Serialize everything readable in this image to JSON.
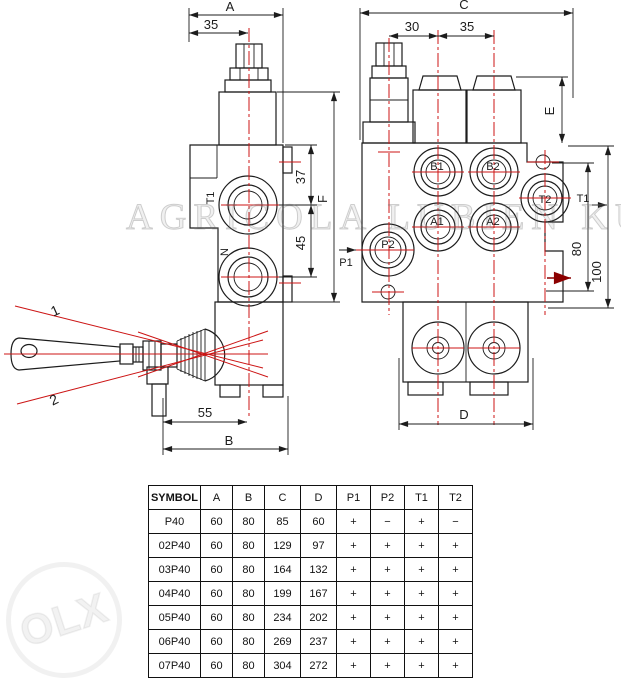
{
  "left_view": {
    "dims": {
      "a": "A",
      "d35": "35",
      "d37": "37",
      "d45": "45",
      "f": "F",
      "d55": "55",
      "b": "B"
    },
    "ports": {
      "t1": "T1",
      "n": "N"
    },
    "lever_positions": {
      "pos1": "1",
      "pos2": "2"
    }
  },
  "right_view": {
    "dims": {
      "c": "C",
      "d30": "30",
      "d35": "35",
      "e": "E",
      "d80": "80",
      "d100": "100",
      "d": "D"
    },
    "ports": {
      "b1": "B1",
      "b2": "B2",
      "a1": "A1",
      "a2": "A2",
      "p2": "P2",
      "t2": "T2"
    },
    "flow": {
      "p1": "P1",
      "t1": "T1"
    }
  },
  "table": {
    "headers": [
      "SYMBOL",
      "A",
      "B",
      "C",
      "D",
      "P1",
      "P2",
      "T1",
      "T2"
    ],
    "rows": [
      [
        "P40",
        "60",
        "80",
        "85",
        "60",
        "+",
        "−",
        "+",
        "−"
      ],
      [
        "02P40",
        "60",
        "80",
        "129",
        "97",
        "+",
        "+",
        "+",
        "+"
      ],
      [
        "03P40",
        "60",
        "80",
        "164",
        "132",
        "+",
        "+",
        "+",
        "+"
      ],
      [
        "04P40",
        "60",
        "80",
        "199",
        "167",
        "+",
        "+",
        "+",
        "+"
      ],
      [
        "05P40",
        "60",
        "80",
        "234",
        "202",
        "+",
        "+",
        "+",
        "+"
      ],
      [
        "06P40",
        "60",
        "80",
        "269",
        "237",
        "+",
        "+",
        "+",
        "+"
      ],
      [
        "07P40",
        "60",
        "80",
        "304",
        "272",
        "+",
        "+",
        "+",
        "+"
      ]
    ]
  },
  "watermarks": {
    "brand": "AGRICOLA LUBIEN KUJAWSKI",
    "olx": "OLX"
  },
  "colors": {
    "centerline_red": "#cc1414",
    "line_black": "#1c1c1c",
    "dark_red_arrow": "#8b0000"
  }
}
